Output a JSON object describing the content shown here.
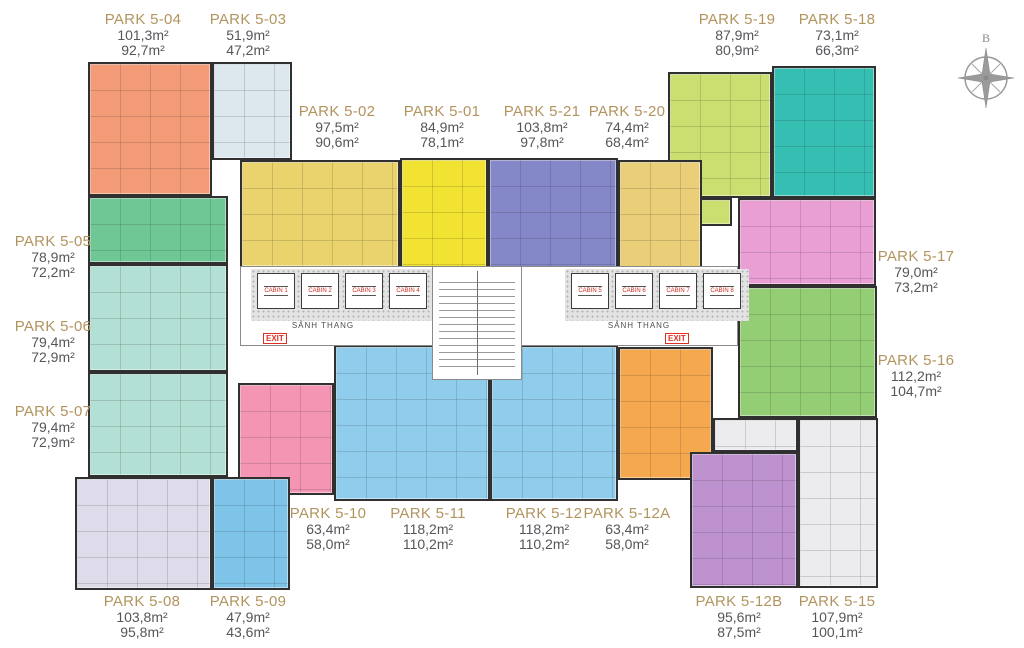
{
  "units": [
    {
      "name": "PARK 5-04",
      "area_gross": "101,3m²",
      "area_net": "92,7m²",
      "color": "#F29B76"
    },
    {
      "name": "PARK 5-03",
      "area_gross": "51,9m²",
      "area_net": "47,2m²",
      "color": "#DCE7EE"
    },
    {
      "name": "PARK 5-19",
      "area_gross": "87,9m²",
      "area_net": "80,9m²",
      "color": "#CBDF70"
    },
    {
      "name": "PARK 5-18",
      "area_gross": "73,1m²",
      "area_net": "66,3m²",
      "color": "#35BFB3"
    },
    {
      "name": "PARK 5-02",
      "area_gross": "97,5m²",
      "area_net": "90,6m²",
      "color": "#EAD36C"
    },
    {
      "name": "PARK 5-01",
      "area_gross": "84,9m²",
      "area_net": "78,1m²",
      "color": "#F2E232"
    },
    {
      "name": "PARK 5-21",
      "area_gross": "103,8m²",
      "area_net": "97,8m²",
      "color": "#8487C8"
    },
    {
      "name": "PARK 5-20",
      "area_gross": "74,4m²",
      "area_net": "68,4m²",
      "color": "#EACF78"
    },
    {
      "name": "PARK 5-05",
      "area_gross": "78,9m²",
      "area_net": "72,2m²",
      "color": "#6FC795"
    },
    {
      "name": "PARK 5-06",
      "area_gross": "79,4m²",
      "area_net": "72,9m²",
      "color": "#B3E0D4"
    },
    {
      "name": "PARK 5-07",
      "area_gross": "79,4m²",
      "area_net": "72,9m²",
      "color": "#B3E0D4"
    },
    {
      "name": "PARK 5-17",
      "area_gross": "79,0m²",
      "area_net": "73,2m²",
      "color": "#EA9FD4"
    },
    {
      "name": "PARK 5-16",
      "area_gross": "112,2m²",
      "area_net": "104,7m²",
      "color": "#93CD74"
    },
    {
      "name": "PARK 5-10",
      "area_gross": "63,4m²",
      "area_net": "58,0m²",
      "color": "#F495B3"
    },
    {
      "name": "PARK 5-11",
      "area_gross": "118,2m²",
      "area_net": "110,2m²",
      "color": "#90CDEC"
    },
    {
      "name": "PARK 5-12",
      "area_gross": "118,2m²",
      "area_net": "110,2m²",
      "color": "#90CDEC"
    },
    {
      "name": "PARK 5-12A",
      "area_gross": "63,4m²",
      "area_net": "58,0m²",
      "color": "#F6A84F"
    },
    {
      "name": "PARK 5-08",
      "area_gross": "103,8m²",
      "area_net": "95,8m²",
      "color": "#DEDCEA"
    },
    {
      "name": "PARK 5-09",
      "area_gross": "47,9m²",
      "area_net": "43,6m²",
      "color": "#7EC4E9"
    },
    {
      "name": "PARK 5-12B",
      "area_gross": "95,6m²",
      "area_net": "87,5m²",
      "color": "#BD92CF"
    },
    {
      "name": "PARK 5-15",
      "area_gross": "107,9m²",
      "area_net": "100,1m²",
      "color": "#ECECEF"
    }
  ],
  "core": {
    "lobby_label": "SẢNH THANG",
    "exit_label": "EXIT",
    "cabins_left": [
      "CABIN 1",
      "CABIN 2",
      "CABIN 3",
      "CABIN 4"
    ],
    "cabins_right": [
      "CABIN 5",
      "CABIN 6",
      "CABIN 7",
      "CABIN 8"
    ]
  },
  "compass": {
    "north_label": "B"
  },
  "colors": {
    "label_title": "#B2945F",
    "label_value": "#54565A",
    "wall": "#303030"
  }
}
